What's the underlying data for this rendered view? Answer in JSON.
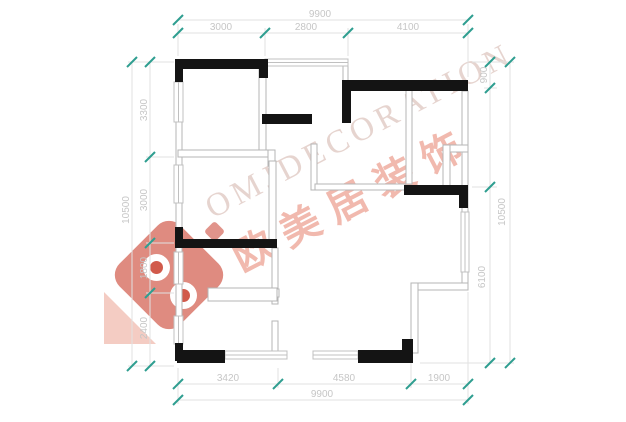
{
  "watermark": {
    "latin_text": "OMJDECORATION",
    "chinese_text": "欧美居装饰"
  },
  "colors": {
    "background": "#ffffff",
    "wall": "#141414",
    "thin_wall": "#b5b5b5",
    "window": "#c0c0c0",
    "dim_line": "#e2e2e2",
    "dim_text": "#c6c6c6",
    "tick": "#2f9e90",
    "logo_red": "#c93d2b",
    "wm_latin_color": "#ceaaa0",
    "wm_cn_color": "#e4745e"
  },
  "plan": {
    "solid_walls": [
      [
        175,
        59,
        93,
        10
      ],
      [
        175,
        59,
        8,
        23
      ],
      [
        259,
        59,
        9,
        19
      ],
      [
        342,
        80,
        126,
        11
      ],
      [
        342,
        80,
        9,
        43
      ],
      [
        262,
        114,
        50,
        10
      ],
      [
        175,
        227,
        8,
        21
      ],
      [
        175,
        239,
        102,
        9
      ],
      [
        404,
        185,
        64,
        10
      ],
      [
        459,
        185,
        9,
        23
      ],
      [
        175,
        343,
        8,
        18
      ],
      [
        177,
        350,
        48,
        13
      ],
      [
        358,
        350,
        55,
        13
      ],
      [
        402,
        339,
        11,
        24
      ]
    ],
    "thin_walls": [
      [
        176,
        62,
        6,
        290
      ],
      [
        259,
        66,
        7,
        85
      ],
      [
        343,
        62,
        5,
        25
      ],
      [
        178,
        150,
        97,
        7
      ],
      [
        268,
        150,
        7,
        16
      ],
      [
        269,
        161,
        7,
        80
      ],
      [
        462,
        91,
        6,
        197
      ],
      [
        443,
        145,
        25,
        7
      ],
      [
        443,
        145,
        7,
        42
      ],
      [
        406,
        88,
        6,
        96
      ],
      [
        311,
        144,
        6,
        46
      ],
      [
        315,
        184,
        90,
        6
      ],
      [
        272,
        248,
        6,
        56
      ],
      [
        272,
        321,
        6,
        31
      ],
      [
        261,
        289,
        18,
        8
      ],
      [
        208,
        288,
        69,
        13
      ],
      [
        411,
        283,
        57,
        7
      ],
      [
        411,
        283,
        7,
        70
      ]
    ],
    "windows": [
      [
        265,
        59,
        83,
        7
      ],
      [
        225,
        351,
        62,
        8
      ],
      [
        313,
        351,
        45,
        8
      ],
      [
        174,
        82,
        9,
        40
      ],
      [
        174,
        165,
        9,
        38
      ],
      [
        174,
        252,
        9,
        32
      ],
      [
        174,
        316,
        9,
        28
      ],
      [
        461,
        212,
        8,
        60
      ]
    ]
  },
  "dimensions": {
    "dim_lines": [
      [
        178,
        20,
        468,
        20
      ],
      [
        178,
        33,
        468,
        33
      ],
      [
        178,
        384,
        468,
        384
      ],
      [
        178,
        400,
        468,
        400
      ],
      [
        132,
        62,
        132,
        366
      ],
      [
        150,
        62,
        150,
        366
      ],
      [
        490,
        62,
        490,
        363
      ],
      [
        510,
        62,
        510,
        363
      ]
    ],
    "extension_lines": [
      [
        178,
        24,
        178,
        56
      ],
      [
        265,
        28,
        265,
        56
      ],
      [
        348,
        28,
        348,
        56
      ],
      [
        468,
        24,
        468,
        77
      ],
      [
        178,
        368,
        178,
        404
      ],
      [
        278,
        368,
        278,
        388
      ],
      [
        411,
        362,
        411,
        388
      ],
      [
        468,
        292,
        468,
        404
      ],
      [
        128,
        62,
        174,
        62
      ],
      [
        146,
        157,
        174,
        157
      ],
      [
        146,
        243,
        174,
        243
      ],
      [
        146,
        293,
        174,
        293
      ],
      [
        128,
        366,
        174,
        366
      ],
      [
        472,
        62,
        514,
        62
      ],
      [
        484,
        88,
        497,
        88
      ],
      [
        472,
        187,
        497,
        187
      ],
      [
        420,
        363,
        514,
        363
      ]
    ],
    "ticks": [
      [
        178,
        20
      ],
      [
        468,
        20
      ],
      [
        178,
        33
      ],
      [
        265,
        33
      ],
      [
        348,
        33
      ],
      [
        468,
        33
      ],
      [
        178,
        384
      ],
      [
        278,
        384
      ],
      [
        411,
        384
      ],
      [
        468,
        384
      ],
      [
        178,
        400
      ],
      [
        468,
        400
      ],
      [
        132,
        62
      ],
      [
        132,
        366
      ],
      [
        150,
        62
      ],
      [
        150,
        157
      ],
      [
        150,
        243
      ],
      [
        150,
        293
      ],
      [
        150,
        366
      ],
      [
        490,
        62
      ],
      [
        490,
        88
      ],
      [
        490,
        187
      ],
      [
        490,
        363
      ],
      [
        510,
        62
      ],
      [
        510,
        363
      ]
    ],
    "labels": [
      {
        "text": "9900",
        "x": 320,
        "y": 17,
        "rot": 0
      },
      {
        "text": "3000",
        "x": 221,
        "y": 30,
        "rot": 0
      },
      {
        "text": "2800",
        "x": 306,
        "y": 30,
        "rot": 0
      },
      {
        "text": "4100",
        "x": 408,
        "y": 30,
        "rot": 0
      },
      {
        "text": "3420",
        "x": 228,
        "y": 381,
        "rot": 0
      },
      {
        "text": "4580",
        "x": 344,
        "y": 381,
        "rot": 0
      },
      {
        "text": "1900",
        "x": 439,
        "y": 381,
        "rot": 0
      },
      {
        "text": "9900",
        "x": 322,
        "y": 397,
        "rot": 0
      },
      {
        "text": "10500",
        "x": 129,
        "y": 210,
        "rot": -90
      },
      {
        "text": "3300",
        "x": 147,
        "y": 110,
        "rot": -90
      },
      {
        "text": "3000",
        "x": 147,
        "y": 200,
        "rot": -90
      },
      {
        "text": "1800",
        "x": 147,
        "y": 268,
        "rot": -90
      },
      {
        "text": "2400",
        "x": 147,
        "y": 328,
        "rot": -90
      },
      {
        "text": "900",
        "x": 487,
        "y": 75,
        "rot": -90
      },
      {
        "text": "6100",
        "x": 485,
        "y": 277,
        "rot": -90
      },
      {
        "text": "10500",
        "x": 505,
        "y": 212,
        "rot": -90
      }
    ]
  }
}
